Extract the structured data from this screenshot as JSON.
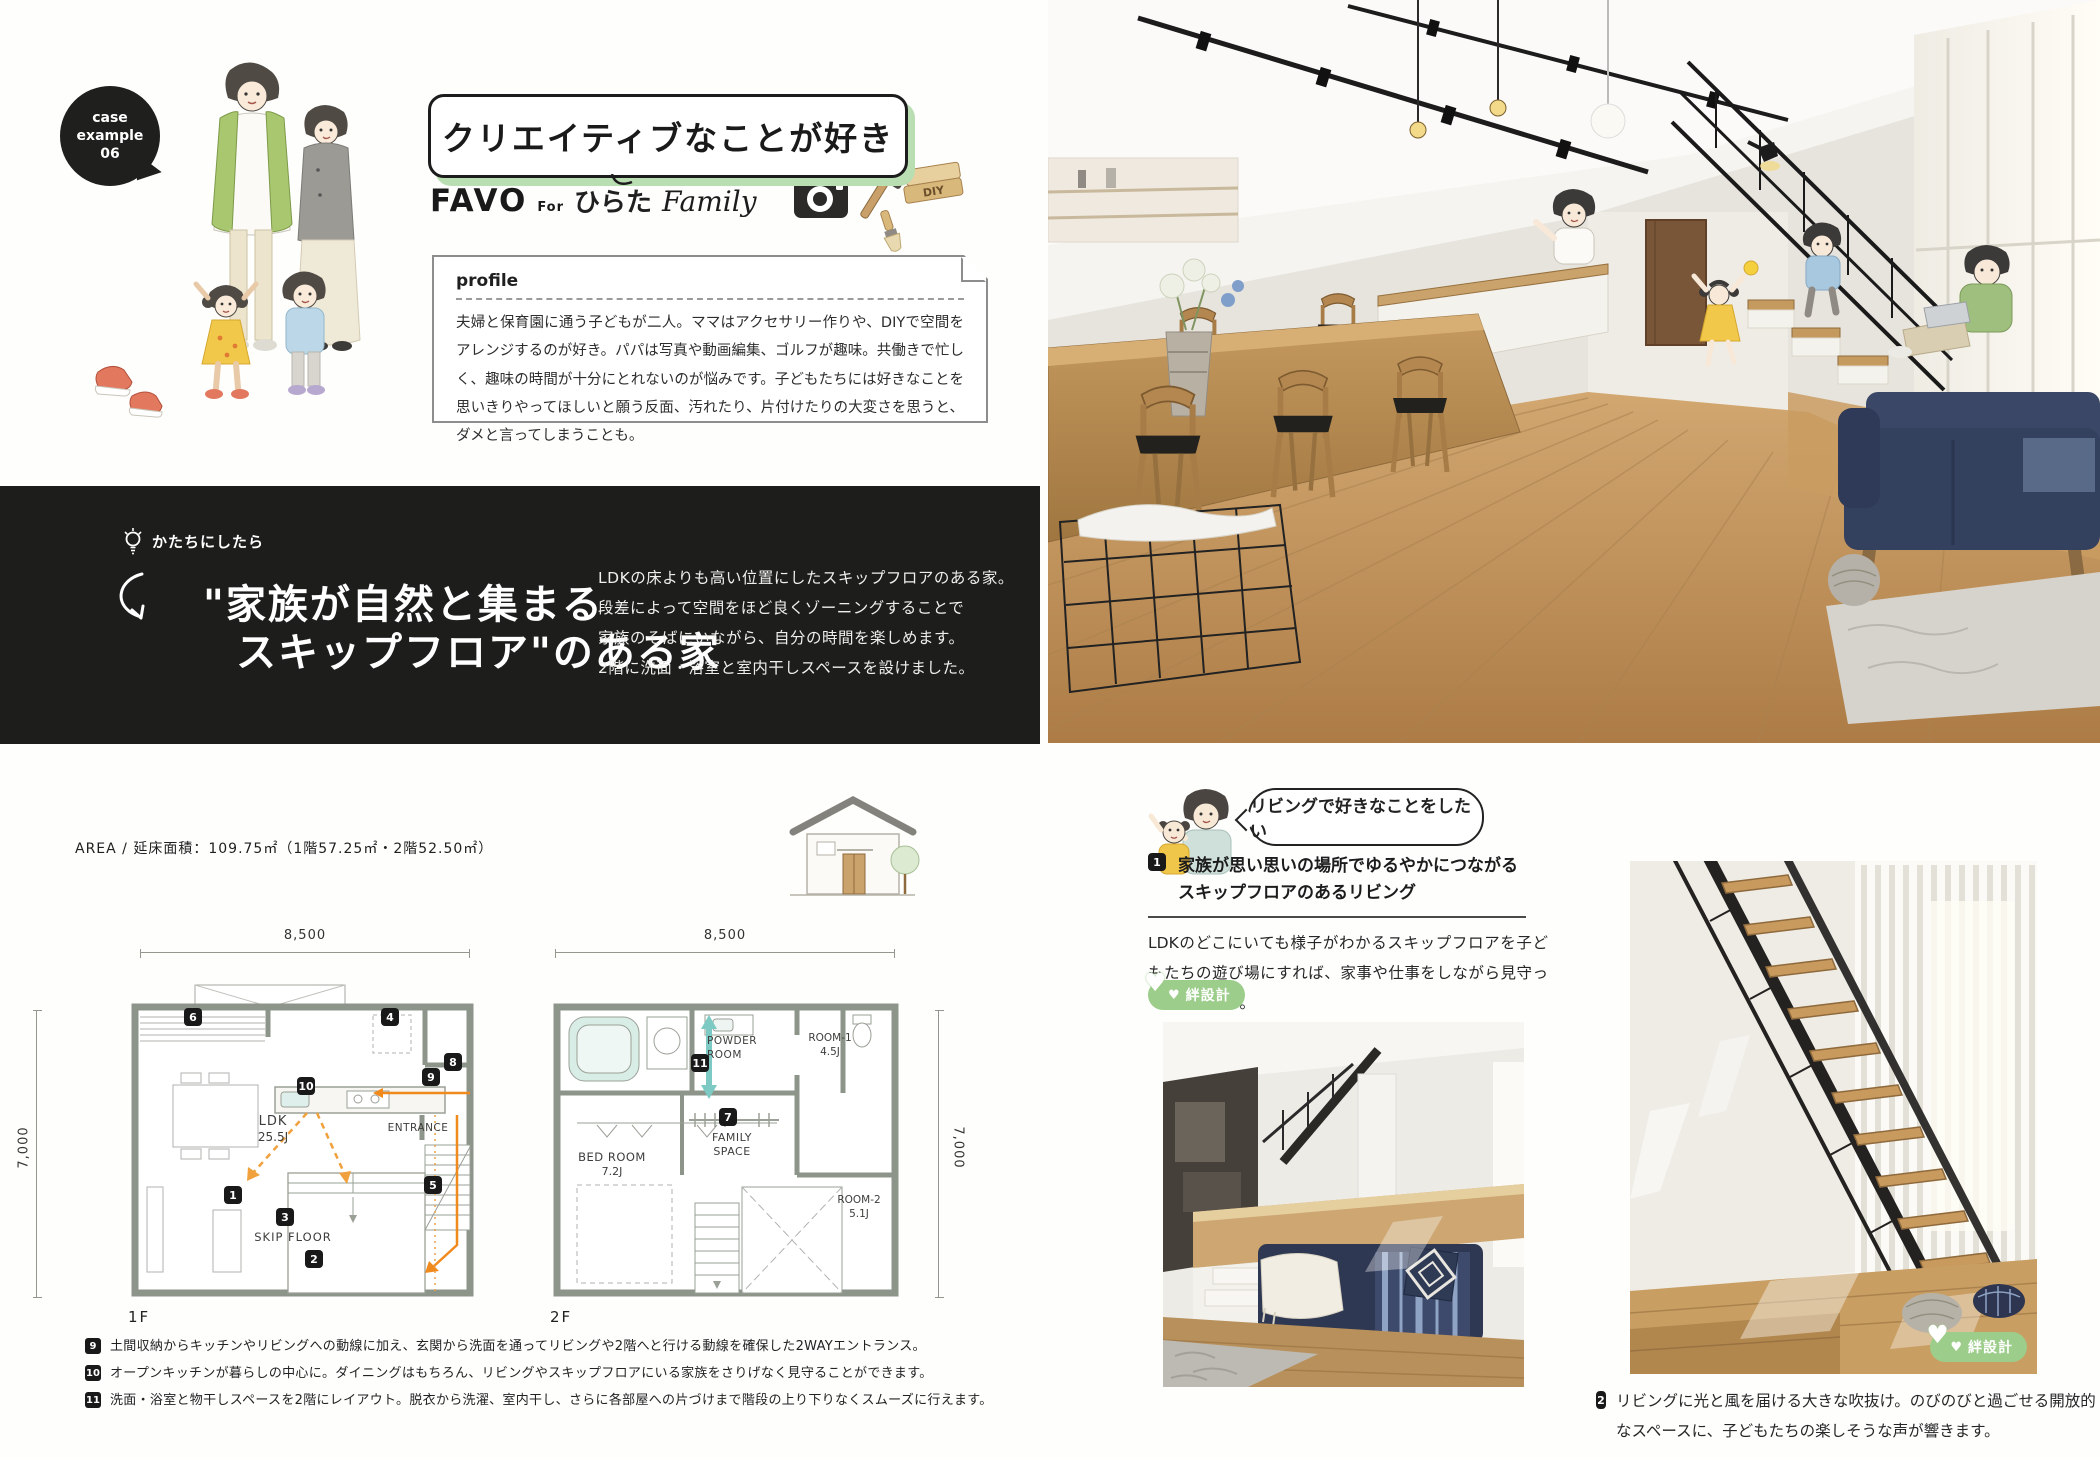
{
  "left_page": {
    "case_badge": {
      "line1": "case",
      "line2": "example",
      "line3": "06"
    },
    "title": "クリエイティブなことが好き",
    "logo": {
      "brand": "FAVO",
      "for_label": "For",
      "family_name": "ひらた",
      "family_label": "Family",
      "diy_sign": "DIY"
    },
    "profile": {
      "heading": "profile",
      "body": "夫婦と保育園に通う子どもが二人。ママはアクセサリー作りや、DIYで空間をアレンジするのが好き。パパは写真や動画編集、ゴルフが趣味。共働きで忙しく、趣味の時間が十分にとれないのが悩みです。子どもたちには好きなことを思いきりやってほしいと願う反面、汚れたり、片付けたりの大変さを思うと、ダメと言ってしまうことも。"
    }
  },
  "concept_band": {
    "eyebrow": "かたちにしたら",
    "headline1": "\"家族が自然と集まる",
    "headline2": "スキップフロア\"のある家",
    "body_lines": [
      "LDKの床よりも高い位置にしたスキップフロアのある家。",
      "段差によって空間をほど良くゾーニングすることで",
      "家族のそばにいながら、自分の時間を楽しめます。",
      "2階に洗面・浴室と室内干しスペースを設けました。"
    ]
  },
  "plans": {
    "area_label": "AREA / 延床面積：109.75㎡（1階57.25㎡・2階52.50㎡）",
    "floor1": {
      "name": "1F",
      "dim_width": "8,500",
      "dim_depth": "7,000",
      "ldk": "LDK",
      "ldk_size": "25.5J",
      "skip": "SKIP FLOOR",
      "entrance": "ENTRANCE",
      "markers": {
        "m1": "1",
        "m2": "2",
        "m3": "3",
        "m4": "4",
        "m5": "5",
        "m6": "6",
        "m8": "8",
        "m9": "9",
        "m10": "10"
      }
    },
    "floor2": {
      "name": "2F",
      "dim_width": "8,500",
      "dim_depth": "7,000",
      "powder1": "POWDER",
      "powder2": "ROOM",
      "bed1": "BED ROOM",
      "bed2": "7.2J",
      "family1": "FAMILY",
      "family2": "SPACE",
      "room1a": "ROOM-1",
      "room1b": "4.5J",
      "room2a": "ROOM-2",
      "room2b": "5.1J",
      "markers": {
        "m7": "7",
        "m11": "11"
      }
    },
    "notes": [
      {
        "num": "9",
        "text": "土間収納からキッチンやリビングへの動線に加え、玄関から洗面を通ってリビングや2階へと行ける動線を確保した2WAYエントランス。"
      },
      {
        "num": "10",
        "text": "オープンキッチンが暮らしの中心に。ダイニングはもちろん、リビングやスキップフロアにいる家族をさりげなく見守ることができます。"
      },
      {
        "num": "11",
        "text": "洗面・浴室と物干しスペースを2階にレイアウト。脱衣から洗濯、室内干し、さらに各部屋への片づけまで階段の上り下りなくスムーズに行えます。"
      }
    ]
  },
  "feature": {
    "bubble": "リビングで好きなことをしたい",
    "point1_num": "1",
    "point1_line1": "家族が思い思いの場所でゆるやかにつながる",
    "point1_line2": "スキップフロアのあるリビング",
    "point1_body": "LDKのどこにいても様子がわかるスキップフロアを子どもたちの遊び場にすれば、家事や仕事をしながら見守っていられます。",
    "badge_heart": "♥",
    "badge_label": "絆設計",
    "point2_num": "2",
    "point2_text": "リビングに光と風を届ける大きな吹抜け。のびのびと過ごせる開放的なスペースに、子どもたちの楽しそうな声が響きます。"
  },
  "colors": {
    "accent_green": "#b9deb2",
    "badge_green": "#9ccd8a",
    "band_black": "#1d1d1b",
    "plan_wall": "#8d948a",
    "arrow_orange": "#f08a1d",
    "arrow_teal": "#7ccac3"
  }
}
